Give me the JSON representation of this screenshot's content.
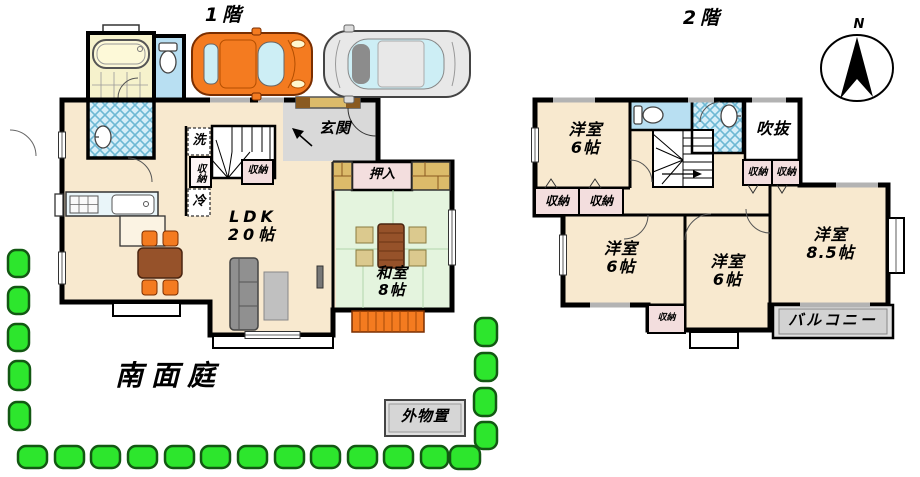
{
  "floor1": {
    "title": "1階",
    "rooms": {
      "ldk": {
        "label": "LDK",
        "size": "20帖"
      },
      "washitsu": {
        "label": "和室",
        "size": "8帖"
      },
      "genkan": {
        "label": "玄関"
      },
      "oshiire": {
        "label": "押入"
      }
    },
    "fixtures": {
      "laundry": "洗",
      "fridge": "冷",
      "storage": "収納"
    },
    "garden": {
      "label": "南面庭"
    },
    "shed": {
      "label": "外物置"
    }
  },
  "floor2": {
    "title": "2階",
    "compass": {
      "north": "N"
    },
    "rooms": {
      "bedroom_nw": {
        "label": "洋室",
        "size": "6帖"
      },
      "bedroom_sw": {
        "label": "洋室",
        "size": "6帖"
      },
      "bedroom_s": {
        "label": "洋室",
        "size": "6帖"
      },
      "bedroom_se": {
        "label": "洋室",
        "size": "8.5帖"
      },
      "void": {
        "label": "吹抜"
      },
      "balcony": {
        "label": "バルコニー"
      }
    },
    "storage_label": "収納"
  },
  "colors": {
    "wall": "#000000",
    "floor_cream": "#f8e9cf",
    "tatami_green": "#e4f4de",
    "bath_yellow": "#f6f2cc",
    "water_blue": "#b8dff2",
    "storage_pink": "#f3dede",
    "entrance_gray": "#d9d9d9",
    "veranda_orange": "#f47b20",
    "bush_green": "#2de62d",
    "car_orange": "#f47b20",
    "car_silver": "#e8e8e8"
  }
}
